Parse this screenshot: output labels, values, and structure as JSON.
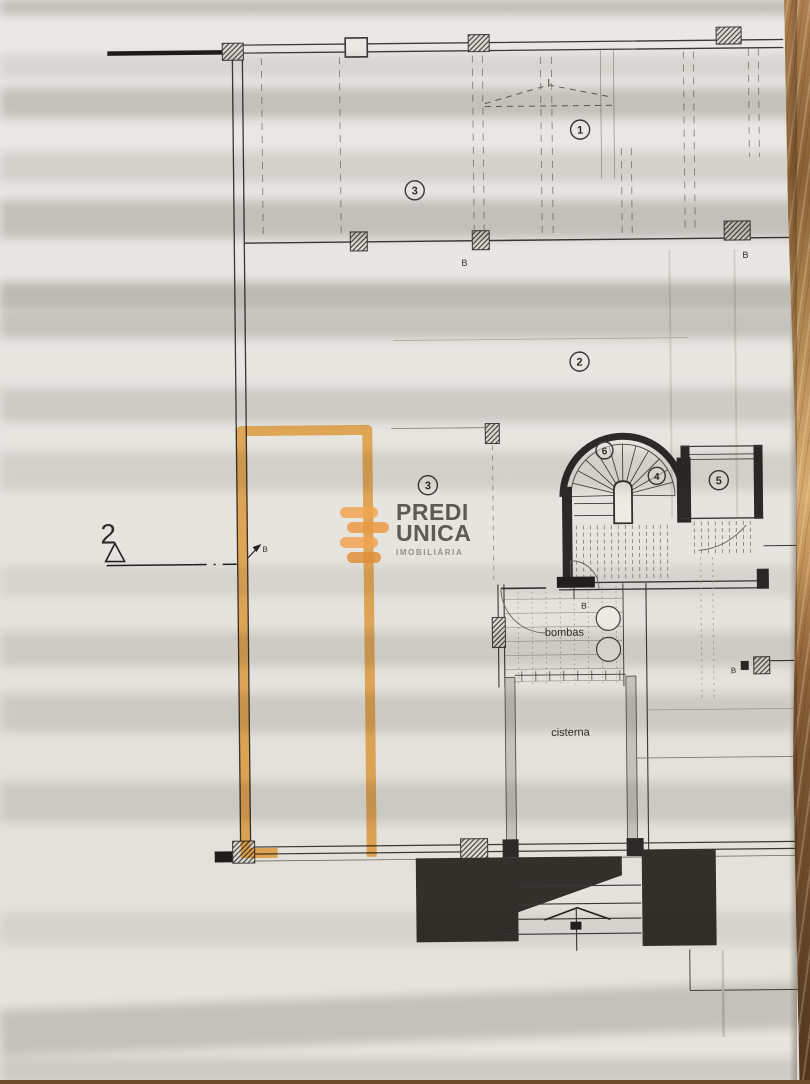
{
  "brand": {
    "name_line1": "PREDI",
    "name_line2": "UNICA",
    "tagline": "IMOBILIÁRIA",
    "bar_color_light": "#F2A452",
    "bar_color_dark": "#E08F38",
    "text_color": "#57534E",
    "tagline_color": "#908C86"
  },
  "highlight": {
    "color": "#F5A940"
  },
  "plan": {
    "section_marker": {
      "number": "2"
    },
    "zone_labels": {
      "z1": "1",
      "z2": "2",
      "z3_upper": "3",
      "z3_lower": "3",
      "z4": "4",
      "z5": "5",
      "z6": "6"
    },
    "room_labels": {
      "pump_room": "bombas",
      "cistern": "cisterna"
    },
    "beam_labels": {
      "b_top_left": "B",
      "b_top_right": "B",
      "b_wall": "B",
      "b_pump": "B",
      "b_right_edge": "B"
    }
  },
  "colors": {
    "paper": "#E9E6E1",
    "ink": "#2F2C28",
    "wood": "#9C7248"
  }
}
